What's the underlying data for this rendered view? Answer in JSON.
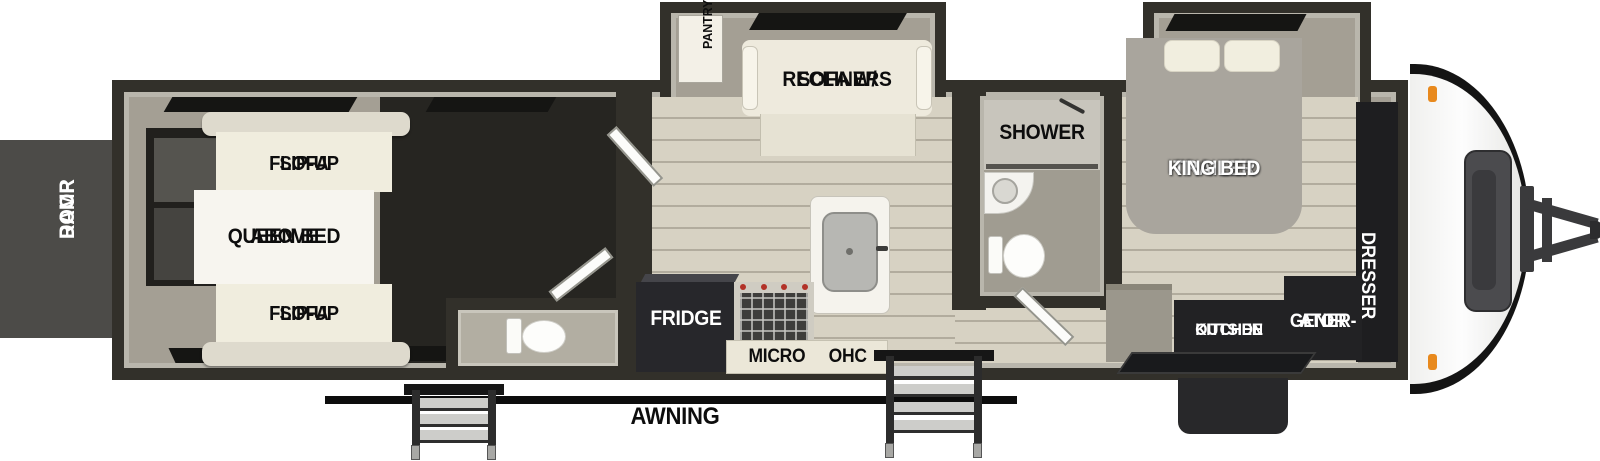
{
  "title": "Toy hauler travel trailer floorplan",
  "colors": {
    "wall": "#32302a",
    "inner_trim": "#b9b6ac",
    "floor_taupe": "#a49f94",
    "floor_dark": "#262521",
    "plank_floor": "#d7d2c3",
    "furniture_cream": "#f0edde",
    "appliance_black": "#222224",
    "bed_gray": "#a9a59d",
    "marker_light_orange": "#e8891d",
    "label_dark": "#0d0d0d",
    "label_light": "#ffffff"
  },
  "exterior": {
    "ramp_door": {
      "line1": "RAMP",
      "line2": "DOOR"
    },
    "awning_label": "AWNING"
  },
  "garage": {
    "flip_up_sofa_top": {
      "line1": "FLIP-UP",
      "line2": "SOFA"
    },
    "queen_bed": {
      "line1": "QUEEN BED",
      "line2": "ABOVE"
    },
    "flip_up_sofa_bottom": {
      "line1": "FLIP-UP",
      "line2": "SOFA"
    }
  },
  "kitchen": {
    "pantry_label": "PANTRY",
    "sofa_recliners": {
      "line1": "SOFA W/",
      "line2": "RECLINERS"
    },
    "fridge_label": "FRIDGE",
    "micro_label": "MICRO",
    "ohc_label": "OHC"
  },
  "bathroom": {
    "shower_label": "SHOWER"
  },
  "bedroom": {
    "king_bed": {
      "line1": "TRAILER",
      "line2": "KING BED"
    },
    "dresser_label": "DRESSER",
    "outside_kitchen": {
      "line1": "OUTSIDE",
      "line2": "KITCHEN"
    },
    "generator": {
      "line1": "GENER-",
      "line2": "ATOR"
    }
  }
}
